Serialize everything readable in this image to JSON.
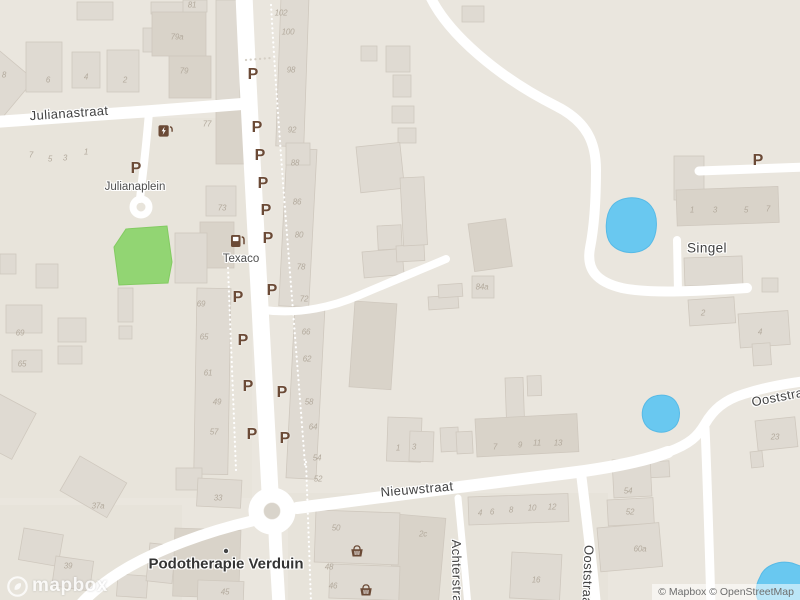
{
  "attribution": {
    "logo_text": "mapbox",
    "copyright": "© Mapbox © OpenStreetMap"
  },
  "map": {
    "colors": {
      "land": "#eae6de",
      "road": "#ffffff",
      "building": "#dfdad2",
      "building_dark": "#d8d2c8",
      "park_green": "#92d573",
      "water_blue": "#69c8f0",
      "parking_brown": "#6b4a36",
      "street_text": "#414141",
      "house_number_text": "#b3aa9d"
    },
    "parking_glyph": "P",
    "street_labels": [
      {
        "text": "Julianastraat",
        "x": 69,
        "y": 113,
        "rot": -4,
        "cls": "street"
      },
      {
        "text": "Julianaplein",
        "x": 135,
        "y": 187,
        "rot": 0,
        "cls": "place"
      },
      {
        "text": "Texaco",
        "x": 241,
        "y": 259,
        "rot": 0,
        "cls": "place"
      },
      {
        "text": "Singel",
        "x": 707,
        "y": 248,
        "rot": 0,
        "cls": "street-lg"
      },
      {
        "text": "Nieuwstraat",
        "x": 417,
        "y": 489,
        "rot": -5,
        "cls": "street"
      },
      {
        "text": "Ooststraat",
        "x": 783,
        "y": 396,
        "rot": -11,
        "cls": "street"
      },
      {
        "text": "Ooststraat",
        "x": 588,
        "y": 577,
        "rot": 92,
        "cls": "street"
      },
      {
        "text": "Achterstraat",
        "x": 457,
        "y": 577,
        "rot": 89,
        "cls": "street"
      },
      {
        "text": "Podotherapie Verduin",
        "x": 226,
        "y": 564,
        "rot": 0,
        "cls": "poi"
      }
    ],
    "parking_markers": [
      {
        "x": 253,
        "y": 75
      },
      {
        "x": 257,
        "y": 128
      },
      {
        "x": 260,
        "y": 156
      },
      {
        "x": 263,
        "y": 184
      },
      {
        "x": 266,
        "y": 211
      },
      {
        "x": 268,
        "y": 239
      },
      {
        "x": 238,
        "y": 298
      },
      {
        "x": 272,
        "y": 291
      },
      {
        "x": 243,
        "y": 341
      },
      {
        "x": 248,
        "y": 387
      },
      {
        "x": 282,
        "y": 393
      },
      {
        "x": 252,
        "y": 435
      },
      {
        "x": 285,
        "y": 439
      },
      {
        "x": 136,
        "y": 169
      },
      {
        "x": 758,
        "y": 161
      }
    ],
    "house_numbers": [
      {
        "t": "8",
        "x": 4,
        "y": 75
      },
      {
        "t": "6",
        "x": 48,
        "y": 80
      },
      {
        "t": "4",
        "x": 86,
        "y": 77
      },
      {
        "t": "2",
        "x": 125,
        "y": 80
      },
      {
        "t": "81",
        "x": 192,
        "y": 5
      },
      {
        "t": "79a",
        "x": 177,
        "y": 37
      },
      {
        "t": "79",
        "x": 184,
        "y": 71
      },
      {
        "t": "77",
        "x": 207,
        "y": 124
      },
      {
        "t": "7",
        "x": 31,
        "y": 155
      },
      {
        "t": "5",
        "x": 50,
        "y": 159
      },
      {
        "t": "3",
        "x": 65,
        "y": 158
      },
      {
        "t": "1",
        "x": 86,
        "y": 152
      },
      {
        "t": "102",
        "x": 281,
        "y": 13
      },
      {
        "t": "100",
        "x": 288,
        "y": 32
      },
      {
        "t": "98",
        "x": 291,
        "y": 70
      },
      {
        "t": "92",
        "x": 292,
        "y": 130
      },
      {
        "t": "88",
        "x": 295,
        "y": 163
      },
      {
        "t": "86",
        "x": 297,
        "y": 202
      },
      {
        "t": "80",
        "x": 299,
        "y": 235
      },
      {
        "t": "78",
        "x": 301,
        "y": 267
      },
      {
        "t": "72",
        "x": 304,
        "y": 299
      },
      {
        "t": "66",
        "x": 306,
        "y": 332
      },
      {
        "t": "62",
        "x": 307,
        "y": 359
      },
      {
        "t": "58",
        "x": 309,
        "y": 402
      },
      {
        "t": "64",
        "x": 313,
        "y": 427
      },
      {
        "t": "54",
        "x": 317,
        "y": 458
      },
      {
        "t": "52",
        "x": 318,
        "y": 479
      },
      {
        "t": "73",
        "x": 222,
        "y": 208
      },
      {
        "t": "69",
        "x": 201,
        "y": 304
      },
      {
        "t": "65",
        "x": 204,
        "y": 337
      },
      {
        "t": "61",
        "x": 208,
        "y": 373
      },
      {
        "t": "49",
        "x": 217,
        "y": 402
      },
      {
        "t": "57",
        "x": 214,
        "y": 432
      },
      {
        "t": "69",
        "x": 20,
        "y": 333
      },
      {
        "t": "65",
        "x": 22,
        "y": 364
      },
      {
        "t": "37a",
        "x": 98,
        "y": 506
      },
      {
        "t": "39",
        "x": 68,
        "y": 566
      },
      {
        "t": "33",
        "x": 218,
        "y": 498
      },
      {
        "t": "45",
        "x": 225,
        "y": 592
      },
      {
        "t": "50",
        "x": 336,
        "y": 528
      },
      {
        "t": "48",
        "x": 329,
        "y": 567
      },
      {
        "t": "46",
        "x": 333,
        "y": 586
      },
      {
        "t": "2c",
        "x": 423,
        "y": 534
      },
      {
        "t": "16",
        "x": 536,
        "y": 580
      },
      {
        "t": "1",
        "x": 398,
        "y": 448
      },
      {
        "t": "3",
        "x": 414,
        "y": 447
      },
      {
        "t": "7",
        "x": 495,
        "y": 447
      },
      {
        "t": "9",
        "x": 520,
        "y": 445
      },
      {
        "t": "11",
        "x": 537,
        "y": 443
      },
      {
        "t": "13",
        "x": 558,
        "y": 443
      },
      {
        "t": "4",
        "x": 480,
        "y": 513
      },
      {
        "t": "6",
        "x": 492,
        "y": 512
      },
      {
        "t": "8",
        "x": 511,
        "y": 510
      },
      {
        "t": "10",
        "x": 532,
        "y": 508
      },
      {
        "t": "12",
        "x": 552,
        "y": 507
      },
      {
        "t": "54",
        "x": 628,
        "y": 491
      },
      {
        "t": "52",
        "x": 630,
        "y": 512
      },
      {
        "t": "60a",
        "x": 640,
        "y": 549
      },
      {
        "t": "23",
        "x": 775,
        "y": 437
      },
      {
        "t": "2",
        "x": 703,
        "y": 313
      },
      {
        "t": "4",
        "x": 760,
        "y": 332
      },
      {
        "t": "1",
        "x": 692,
        "y": 210
      },
      {
        "t": "3",
        "x": 715,
        "y": 210
      },
      {
        "t": "5",
        "x": 746,
        "y": 210
      },
      {
        "t": "7",
        "x": 768,
        "y": 209
      },
      {
        "t": "84a",
        "x": 482,
        "y": 287
      }
    ],
    "icons": [
      {
        "name": "fuel-icon",
        "x": 238,
        "y": 241
      },
      {
        "name": "ev-charging-icon",
        "x": 166,
        "y": 131
      },
      {
        "name": "basket-icon",
        "x": 357,
        "y": 551
      },
      {
        "name": "basket-icon",
        "x": 366,
        "y": 590
      },
      {
        "name": "poi-dot",
        "x": 226,
        "y": 551
      }
    ]
  }
}
